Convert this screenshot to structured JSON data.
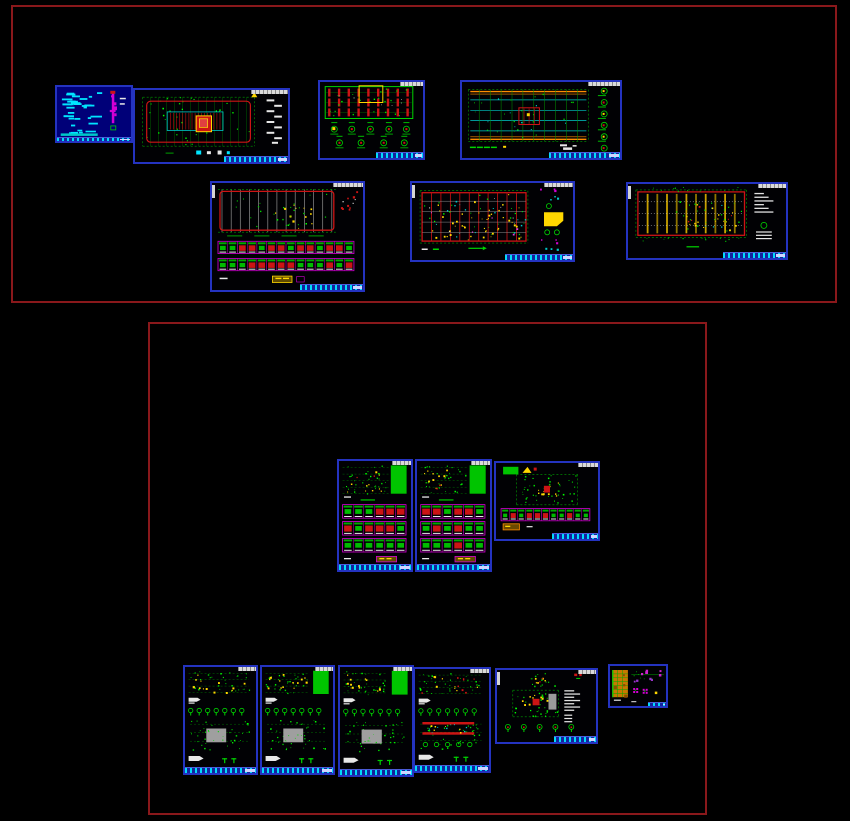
{
  "app": {
    "name": "cad-model-space",
    "description": "CAD model space view of a structural drawing set; two crossing-selection boundary rectangles over a black background; no legible text at this zoom level",
    "background": "#000000"
  },
  "palette": {
    "sheetBorder": "#2433c0",
    "titleBlue": "#14239e",
    "boundaryRed": "#8a181b",
    "green": "#00d400",
    "green2": "#00a000",
    "greenFill": "#00c400",
    "cyan": "#00e5ff",
    "cyan2": "#00c8c8",
    "red": "#cc1414",
    "yellow": "#ffd700",
    "orange": "#ff8c00",
    "magenta": "#d400d4",
    "purple": "#9933cc",
    "gray": "#909090",
    "white": "#e8e8e8",
    "coverBg": "#000078",
    "tableOrange": "#c87800"
  },
  "groups": [
    {
      "id": "top",
      "name": "selection-boundary-top",
      "x": 11,
      "y": 5,
      "w": 826,
      "h": 298
    },
    {
      "id": "bottom",
      "name": "selection-boundary-bottom",
      "x": 148,
      "y": 322,
      "w": 559,
      "h": 493
    }
  ],
  "sheets": [
    {
      "id": "cover-sheet",
      "label": "cover / notes sheet",
      "kind": "cover",
      "x": 55,
      "y": 85,
      "w": 78,
      "h": 58,
      "seed": 11,
      "opts": {
        "tagW": 0,
        "titleW": 0.9,
        "titleH": 4,
        "titleFull": true
      }
    },
    {
      "id": "floor-plan",
      "label": "floor framing plan",
      "kind": "planA",
      "x": 133,
      "y": 88,
      "w": 157,
      "h": 76,
      "seed": 21,
      "opts": {
        "tagW": 24,
        "titleW": 0.42,
        "titleH": 6
      }
    },
    {
      "id": "column-layout",
      "label": "column layout + details",
      "kind": "columnPlan",
      "x": 318,
      "y": 80,
      "w": 107,
      "h": 80,
      "seed": 31,
      "opts": {
        "tagW": 22,
        "titleW": 0.46,
        "titleH": 6
      }
    },
    {
      "id": "beam-layout-1",
      "label": "beam layout plan 1",
      "kind": "beamA",
      "x": 460,
      "y": 80,
      "w": 162,
      "h": 80,
      "seed": 41,
      "opts": {
        "tagW": 20,
        "titleW": 0.45,
        "titleH": 6
      }
    },
    {
      "id": "foundation-plan",
      "label": "foundation plan + piles",
      "kind": "foundation",
      "x": 210,
      "y": 181,
      "w": 155,
      "h": 111,
      "seed": 51,
      "opts": {
        "tagW": 20,
        "leftTag": true,
        "titleW": 0.42,
        "titleH": 6
      }
    },
    {
      "id": "beam-layout-2",
      "label": "beam layout plan 2",
      "kind": "beamB",
      "x": 410,
      "y": 181,
      "w": 165,
      "h": 81,
      "seed": 61,
      "opts": {
        "tagW": 18,
        "leftTag": true,
        "titleW": 0.42,
        "titleH": 6
      }
    },
    {
      "id": "beam-layout-3",
      "label": "beam layout plan 3",
      "kind": "beamC",
      "x": 626,
      "y": 182,
      "w": 162,
      "h": 78,
      "seed": 71,
      "opts": {
        "tagW": 18,
        "leftTag": true,
        "titleW": 0.4,
        "titleH": 6
      }
    },
    {
      "id": "detail-sheet-1",
      "label": "wall/slab detail sheet 1",
      "kind": "tallDetail",
      "x": 337,
      "y": 459,
      "w": 76,
      "h": 113,
      "seed": 81,
      "opts": {
        "tagW": 26,
        "titleFull": true,
        "titleW": 1,
        "titleH": 6
      }
    },
    {
      "id": "detail-sheet-2",
      "label": "wall/slab detail sheet 2",
      "kind": "tallDetail",
      "x": 415,
      "y": 459,
      "w": 77,
      "h": 113,
      "seed": 91,
      "opts": {
        "tagW": 26,
        "titleFull": true,
        "titleW": 1,
        "titleH": 6
      }
    },
    {
      "id": "roof-detail",
      "label": "roof plan + details",
      "kind": "wideRoof",
      "x": 494,
      "y": 461,
      "w": 106,
      "h": 80,
      "seed": 101,
      "opts": {
        "tagW": 20,
        "titleW": 0.45,
        "titleH": 6
      }
    },
    {
      "id": "unit-plan-1",
      "label": "unit structural plan 1",
      "kind": "portrait",
      "x": 183,
      "y": 665,
      "w": 75,
      "h": 110,
      "seed": 111,
      "opts": {
        "tagW": 26,
        "titleFull": true,
        "titleW": 1,
        "titleH": 6
      },
      "variant": "plain"
    },
    {
      "id": "unit-plan-2",
      "label": "unit structural plan 2",
      "kind": "portrait",
      "x": 260,
      "y": 665,
      "w": 75,
      "h": 110,
      "seed": 121,
      "opts": {
        "tagW": 26,
        "titleFull": true,
        "titleW": 1,
        "titleH": 6
      },
      "variant": "greenfill"
    },
    {
      "id": "unit-plan-3",
      "label": "unit structural plan 3",
      "kind": "portrait",
      "x": 338,
      "y": 665,
      "w": 76,
      "h": 112,
      "seed": 131,
      "opts": {
        "tagW": 26,
        "titleFull": true,
        "titleW": 1,
        "titleH": 6
      },
      "variant": "greenfill"
    },
    {
      "id": "unit-plan-4",
      "label": "unit structural plan 4",
      "kind": "portrait",
      "x": 413,
      "y": 667,
      "w": 78,
      "h": 106,
      "seed": 141,
      "opts": {
        "tagW": 26,
        "titleFull": true,
        "titleW": 1,
        "titleH": 6
      },
      "variant": "red"
    },
    {
      "id": "stair-plan",
      "label": "stair/core plan",
      "kind": "wideB5",
      "x": 495,
      "y": 668,
      "w": 103,
      "h": 76,
      "seed": 151,
      "opts": {
        "tagW": 18,
        "leftTag": true,
        "titleW": 0.42,
        "titleH": 6
      }
    },
    {
      "id": "schedule-sheet",
      "label": "small schedule sheet",
      "kind": "smallSheet",
      "x": 608,
      "y": 664,
      "w": 60,
      "h": 44,
      "seed": 161,
      "opts": {
        "tagW": 0,
        "titleW": 0.32,
        "titleH": 4
      }
    }
  ]
}
